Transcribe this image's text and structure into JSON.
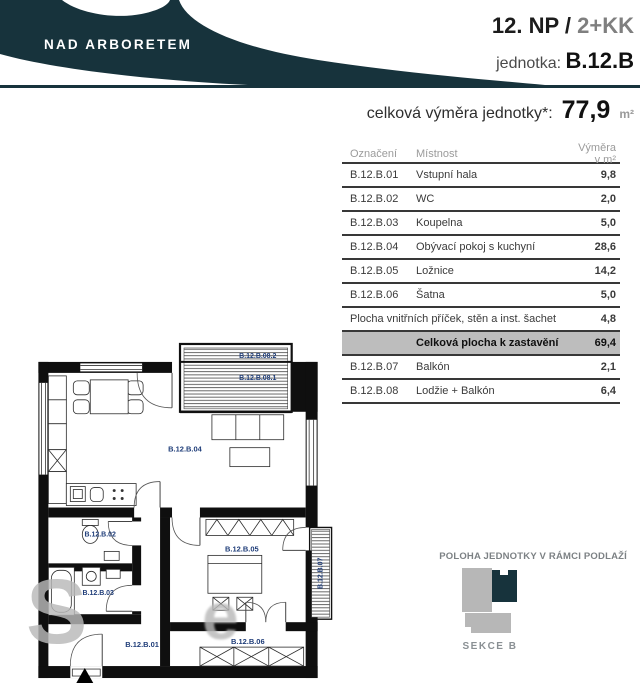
{
  "header": {
    "brand": "NAD ARBORETEM",
    "floor": "12. NP /",
    "layout": "2+KK",
    "unit_label": "jednotka:",
    "unit_code": "B.12.B",
    "total_label": "celková výměra jednotky*:",
    "total_value": "77,9",
    "total_unit": "m²"
  },
  "table": {
    "col_code": "Označení",
    "col_room": "Místnost",
    "col_area": "Výměra v m²",
    "rows": [
      {
        "code": "B.12.B.01",
        "room": "Vstupní hala",
        "area": "9,8"
      },
      {
        "code": "B.12.B.02",
        "room": "WC",
        "area": "2,0"
      },
      {
        "code": "B.12.B.03",
        "room": "Koupelna",
        "area": "5,0"
      },
      {
        "code": "B.12.B.04",
        "room": "Obývací pokoj s kuchyní",
        "area": "28,6"
      },
      {
        "code": "B.12.B.05",
        "room": "Ložnice",
        "area": "14,2"
      },
      {
        "code": "B.12.B.06",
        "room": "Šatna",
        "area": "5,0"
      }
    ],
    "partition": {
      "label": "Plocha vnitřních příček, stěn a inst. šachet",
      "area": "4,8"
    },
    "total": {
      "label": "Celková plocha k zastavění",
      "area": "69,4"
    },
    "extras": [
      {
        "code": "B.12.B.07",
        "room": "Balkón",
        "area": "2,1"
      },
      {
        "code": "B.12.B.08",
        "room": "Lodžie + Balkón",
        "area": "6,4"
      }
    ]
  },
  "plan": {
    "hall": "B.12.B.01",
    "wc": "B.12.B.02",
    "bath": "B.12.B.03",
    "living": "B.12.B.04",
    "bedroom": "B.12.B.05",
    "closet": "B.12.B.06",
    "balcony": "B.12.B.07",
    "loggia_top": "B.12.B.08.2",
    "loggia": "B.12.B.08.1"
  },
  "watermark": {
    "letter1": "S",
    "letter2": "e"
  },
  "location": {
    "title": "POLOHA JEDNOTKY V RÁMCI PODLAŽÍ",
    "section": "SEKCE B"
  },
  "colors": {
    "brand": "#17333C",
    "label_blue": "#1E3C78",
    "row_highlight": "#BDBDBD"
  }
}
